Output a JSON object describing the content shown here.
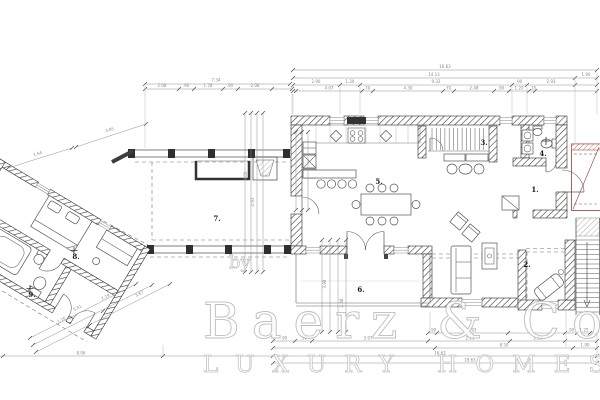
{
  "watermark": {
    "by": "by",
    "brand": "Baerz & Co",
    "tagline": "LUXURY HOMES"
  },
  "rooms": {
    "r1": "1.",
    "r2": "2.",
    "r3": "3.",
    "r4": "4.",
    "r5": "5.",
    "r6": "6.",
    "r7": "7.",
    "r8": "8.",
    "r9": "9."
  },
  "dims": {
    "left_total": "7.34",
    "left_segs": [
      "2.08",
      ".90",
      "1.78",
      ".90",
      "2.08"
    ],
    "right_row1": "16.63",
    "right_row2": [
      "14.13",
      "1.90"
    ],
    "right_row3": [
      "2.90",
      "1.20",
      "9.32",
      ".90",
      "2.93"
    ],
    "right_row4": [
      "4.07",
      ".70",
      "4.30",
      ".70",
      "2.48",
      ".90",
      "1.20",
      ".35"
    ],
    "bottom_row1": [
      ".90",
      "5.93",
      ".90",
      "1.25"
    ],
    "bottom_row2": [
      ".90",
      ".90",
      "3.97",
      "2.11",
      "2.51"
    ],
    "bottom_row3": [
      "8.50",
      "1.90"
    ],
    "bottom_row4": [
      "8.06",
      "16.63"
    ],
    "bottom_row5": "19.63",
    "diag_upper": [
      "1.64",
      "3.85"
    ],
    "diag_lower": [
      "5.41",
      "1.16",
      "2.19",
      "3.67"
    ],
    "vertical": [
      "3.00",
      "2.93",
      "3.98",
      "2.48"
    ]
  }
}
